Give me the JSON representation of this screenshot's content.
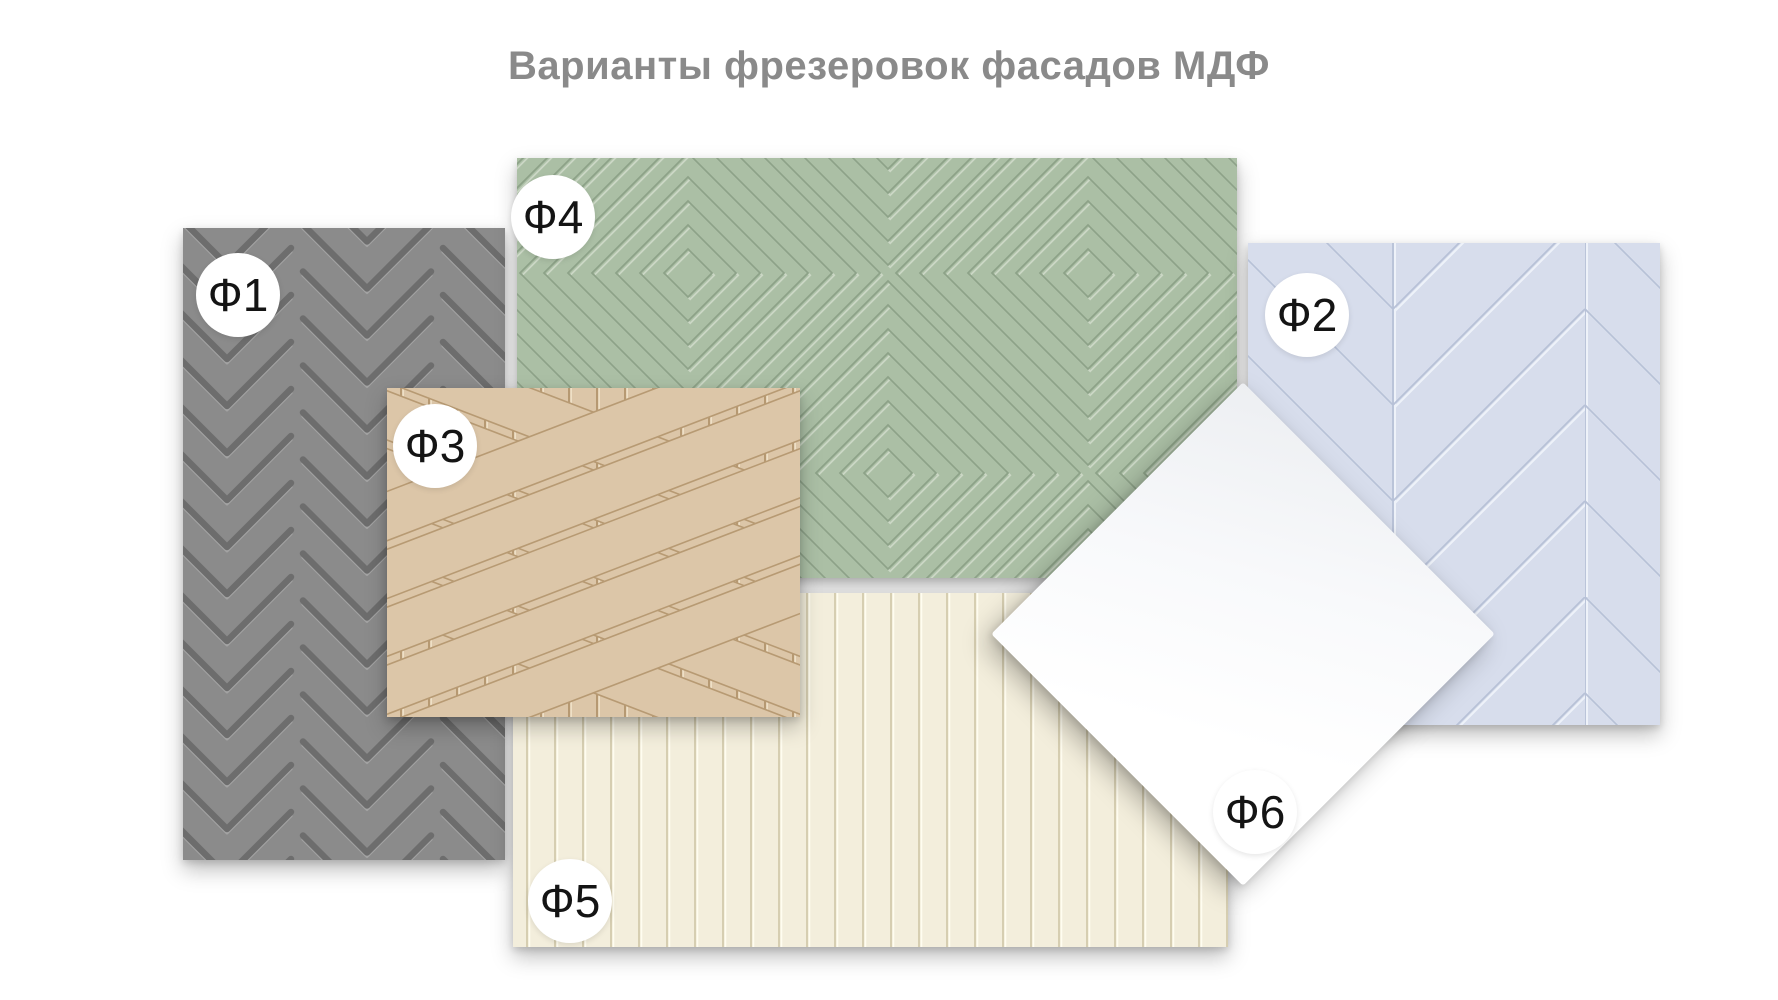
{
  "title": "Варианты фрезеровок фасадов МДФ",
  "title_color": "#8a8a8a",
  "background_color": "#ffffff",
  "label_text_color": "#141414",
  "label_badge_color": "#ffffff",
  "panels": [
    {
      "label": "Ф1",
      "pattern": "chevron-zigzag-grooves",
      "color": "#8b8b8b"
    },
    {
      "label": "Ф2",
      "pattern": "herringbone-chevron-planks",
      "color": "#d7ddec"
    },
    {
      "label": "Ф3",
      "pattern": "crossing-diagonal-planks-over-beadboard",
      "color": "#dcc6a8"
    },
    {
      "label": "Ф4",
      "pattern": "nested-concentric-diamonds",
      "color": "#abbfa5"
    },
    {
      "label": "Ф5",
      "pattern": "vertical-beadboard-grooves",
      "color": "#f3eedc"
    },
    {
      "label": "Ф6",
      "pattern": "plain-flat-smooth",
      "color": "#ffffff"
    }
  ]
}
